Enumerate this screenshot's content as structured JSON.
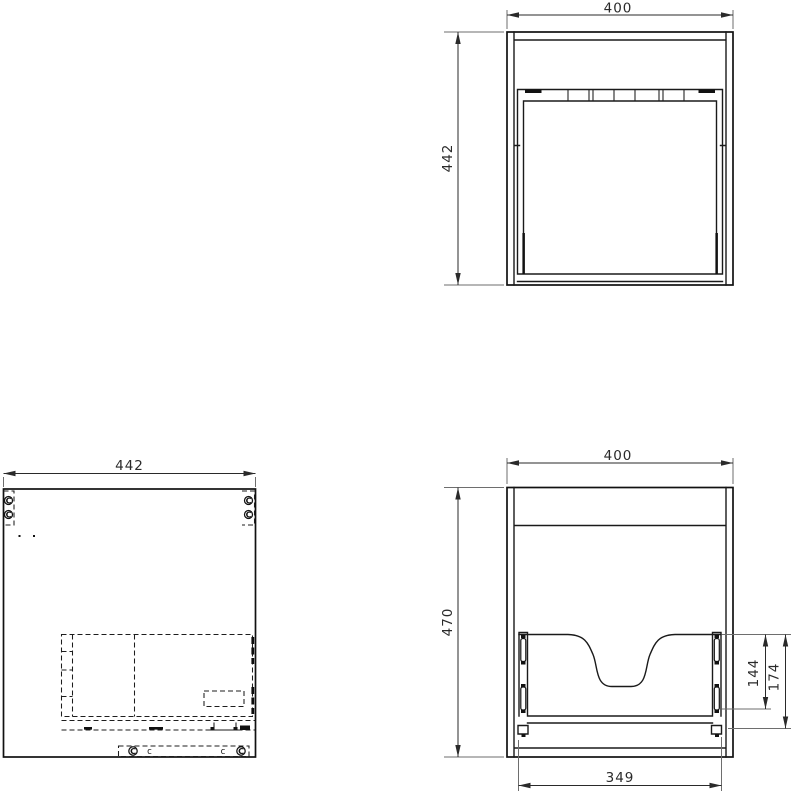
{
  "drawing": {
    "type": "technical-drawing",
    "subject": "wall-hung vanity cabinet with drawer",
    "background": "#ffffff",
    "colors": {
      "object_line": "#1a1a1a",
      "dimension_line": "#2a2a2a",
      "extension_line": "#6e6e6e"
    },
    "views": {
      "top": {
        "title": "top-view",
        "width_mm": "400",
        "depth_mm": "442"
      },
      "side": {
        "title": "side-view",
        "depth_mm": "442",
        "cam_lock_label": "C",
        "screw_label": "c"
      },
      "front": {
        "title": "front-view",
        "width_mm": "400",
        "height_mm": "470",
        "cutout_height_mm": "144",
        "cutout_total_height_mm": "174",
        "drawer_width_mm": "349"
      }
    }
  }
}
